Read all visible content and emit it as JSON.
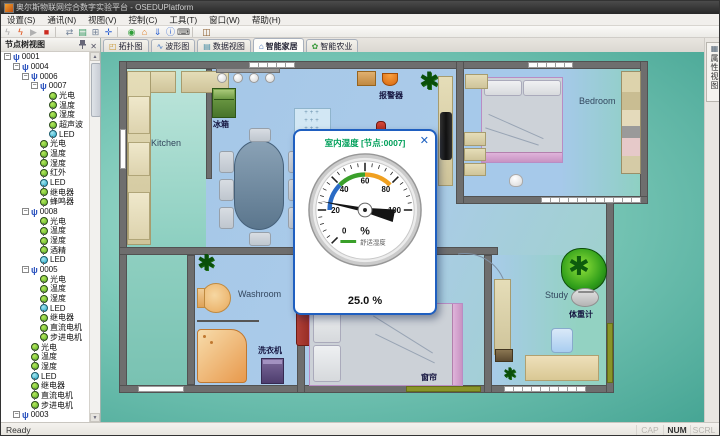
{
  "window": {
    "title": "奥尔斯物联网综合数字实验平台 - OSEDUPlatform"
  },
  "menu": {
    "items": [
      "设置(S)",
      "通讯(N)",
      "视图(V)",
      "控制(C)",
      "工具(T)",
      "窗口(W)",
      "帮助(H)"
    ]
  },
  "toolbar": {
    "items": [
      {
        "name": "offline-lightning",
        "glyph": "ϟ",
        "color": "#a8a8a8"
      },
      {
        "name": "online-lightning",
        "glyph": "ϟ",
        "color": "#e04b10"
      },
      {
        "name": "play",
        "glyph": "▶",
        "color": "#b0b0b0"
      },
      {
        "name": "stop",
        "glyph": "■",
        "color": "#cc2b20"
      },
      {
        "name": "sep1",
        "sep": true
      },
      {
        "name": "serial",
        "glyph": "⇄",
        "color": "#74849a"
      },
      {
        "name": "image-view",
        "glyph": "▤",
        "color": "#3f9e68"
      },
      {
        "name": "panel-layout",
        "glyph": "⊞",
        "color": "#6f7f95"
      },
      {
        "name": "anchor",
        "glyph": "✛",
        "color": "#2a5fd0"
      },
      {
        "name": "sep2",
        "sep": true
      },
      {
        "name": "run",
        "glyph": "◉",
        "color": "#2f9e38"
      },
      {
        "name": "home",
        "glyph": "⌂",
        "color": "#e07b1f"
      },
      {
        "name": "download",
        "glyph": "⇓",
        "color": "#2a5fd0"
      },
      {
        "name": "info",
        "glyph": "ⓘ",
        "color": "#2a5fd0"
      },
      {
        "name": "keyboard",
        "glyph": "⌨",
        "color": "#4a4a4a"
      },
      {
        "name": "sep3",
        "sep": true
      },
      {
        "name": "exit",
        "glyph": "◫",
        "color": "#8a5a2a"
      }
    ]
  },
  "tabs": {
    "items": [
      {
        "label": "拓扑图",
        "icon": "◰",
        "icon_color": "#c8962f",
        "active": false
      },
      {
        "label": "波形图",
        "icon": "∿",
        "icon_color": "#3f74c2",
        "active": false
      },
      {
        "label": "数据视图",
        "icon": "▤",
        "icon_color": "#4a8fa6",
        "active": false
      },
      {
        "label": "智能家居",
        "icon": "⌂",
        "icon_color": "#2f62b8",
        "active": true
      },
      {
        "label": "智能农业",
        "icon": "✿",
        "icon_color": "#3c9a3c",
        "active": false
      }
    ]
  },
  "tree": {
    "title": "节点树视图",
    "items": [
      {
        "label": "0001",
        "level": 0,
        "kind": "node",
        "box": "-"
      },
      {
        "label": "0004",
        "level": 1,
        "kind": "node",
        "box": "-"
      },
      {
        "label": "0006",
        "level": 2,
        "kind": "node",
        "box": "-"
      },
      {
        "label": "0007",
        "level": 3,
        "kind": "node",
        "box": "-"
      },
      {
        "label": "光电",
        "level": 4,
        "kind": "sensor"
      },
      {
        "label": "温度",
        "level": 4,
        "kind": "sensor"
      },
      {
        "label": "湿度",
        "level": 4,
        "kind": "sensor"
      },
      {
        "label": "超声波",
        "level": 4,
        "kind": "sensor"
      },
      {
        "label": "LED",
        "level": 4,
        "kind": "led"
      },
      {
        "label": "光电",
        "level": 3,
        "kind": "sensor"
      },
      {
        "label": "温度",
        "level": 3,
        "kind": "sensor"
      },
      {
        "label": "湿度",
        "level": 3,
        "kind": "sensor"
      },
      {
        "label": "红外",
        "level": 3,
        "kind": "sensor"
      },
      {
        "label": "LED",
        "level": 3,
        "kind": "led"
      },
      {
        "label": "继电器",
        "level": 3,
        "kind": "sensor"
      },
      {
        "label": "蜂鸣器",
        "level": 3,
        "kind": "sensor"
      },
      {
        "label": "0008",
        "level": 2,
        "kind": "node",
        "box": "-"
      },
      {
        "label": "光电",
        "level": 3,
        "kind": "sensor"
      },
      {
        "label": "温度",
        "level": 3,
        "kind": "sensor"
      },
      {
        "label": "湿度",
        "level": 3,
        "kind": "sensor"
      },
      {
        "label": "酒精",
        "level": 3,
        "kind": "sensor"
      },
      {
        "label": "LED",
        "level": 3,
        "kind": "led"
      },
      {
        "label": "0005",
        "level": 2,
        "kind": "node",
        "box": "-"
      },
      {
        "label": "光电",
        "level": 3,
        "kind": "sensor"
      },
      {
        "label": "温度",
        "level": 3,
        "kind": "sensor"
      },
      {
        "label": "湿度",
        "level": 3,
        "kind": "sensor"
      },
      {
        "label": "LED",
        "level": 3,
        "kind": "led"
      },
      {
        "label": "继电器",
        "level": 3,
        "kind": "sensor"
      },
      {
        "label": "直流电机",
        "level": 3,
        "kind": "sensor"
      },
      {
        "label": "步进电机",
        "level": 3,
        "kind": "sensor"
      },
      {
        "label": "光电",
        "level": 2,
        "kind": "sensor"
      },
      {
        "label": "温度",
        "level": 2,
        "kind": "sensor"
      },
      {
        "label": "湿度",
        "level": 2,
        "kind": "sensor"
      },
      {
        "label": "LED",
        "level": 2,
        "kind": "led"
      },
      {
        "label": "继电器",
        "level": 2,
        "kind": "sensor"
      },
      {
        "label": "直流电机",
        "level": 2,
        "kind": "sensor"
      },
      {
        "label": "步进电机",
        "level": 2,
        "kind": "sensor"
      },
      {
        "label": "0003",
        "level": 1,
        "kind": "node",
        "box": "-"
      }
    ]
  },
  "floorplan": {
    "labels": {
      "kitchen": "Kitchen",
      "fridge": "冰箱",
      "alarm": "报警器",
      "bedroom1": "Bedroom",
      "washroom": "Washroom",
      "washer": "洗衣机",
      "bedroom2": "Bedroom",
      "curtain": "窗帘",
      "study": "Study",
      "scale": "体重计"
    }
  },
  "dialog": {
    "title": "室内湿度 [节点:0007]",
    "close_glyph": "✕",
    "gauge": {
      "min": 0,
      "max": 100,
      "value": 25.0,
      "unit": "%",
      "legend": "舒适湿度",
      "reading": "25.0 %",
      "tick_values": [
        0,
        20,
        40,
        60,
        80,
        100
      ],
      "arcs": [
        {
          "from": 20,
          "to": 40,
          "color": "#2a6bc5"
        },
        {
          "from": 40,
          "to": 60,
          "color": "#3aa02a"
        },
        {
          "from": 60,
          "to": 80,
          "color": "#f0a020"
        }
      ]
    }
  },
  "right_panel": {
    "label": "属性视图"
  },
  "status": {
    "left": "Ready",
    "indicators": [
      {
        "label": "CAP",
        "active": false
      },
      {
        "label": "NUM",
        "active": true
      },
      {
        "label": "SCRL",
        "active": false
      }
    ]
  }
}
